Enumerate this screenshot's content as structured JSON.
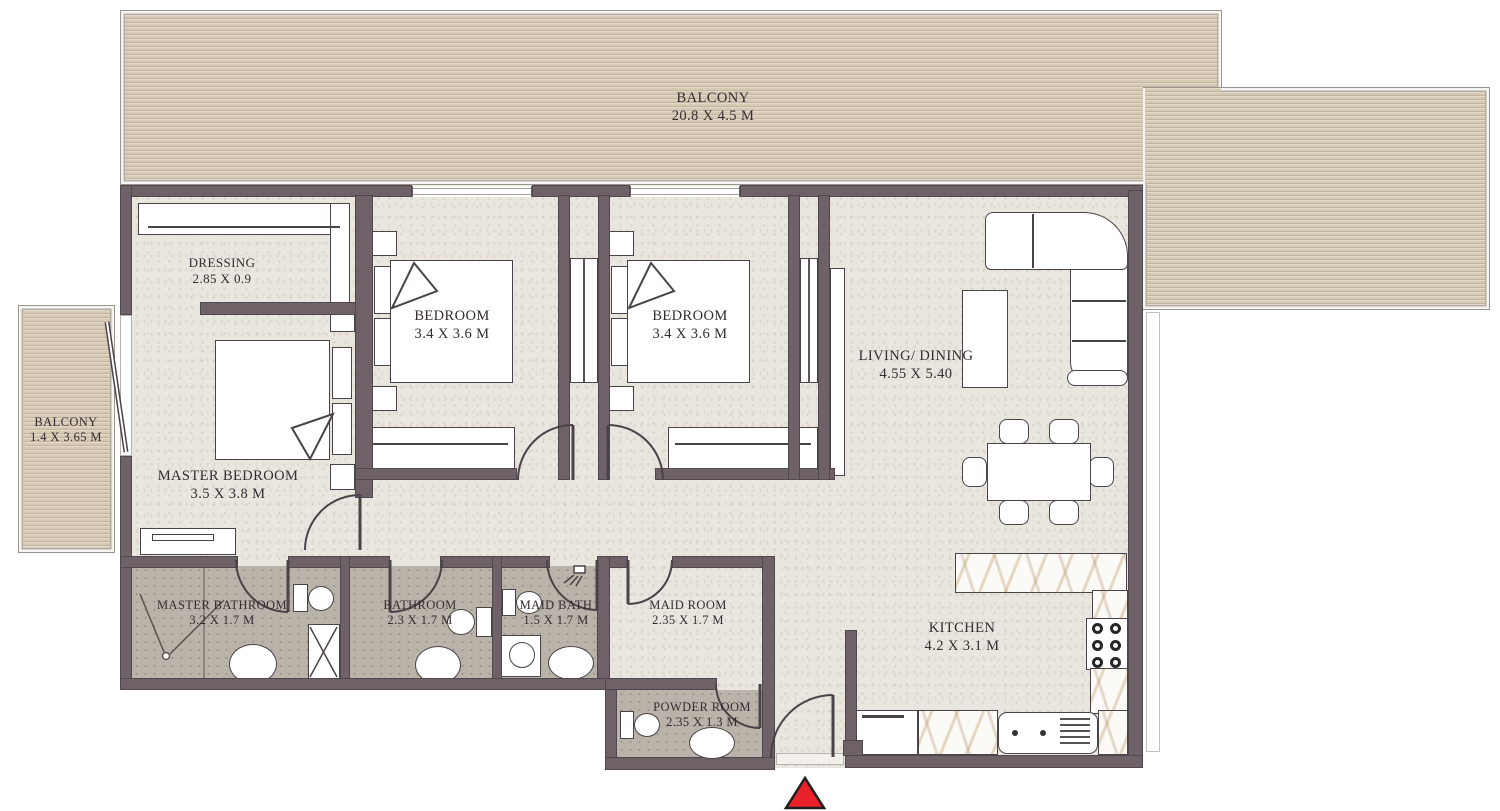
{
  "plan": {
    "rooms": {
      "balcony_top": {
        "name": "BALCONY",
        "dims": "20.8 X 4.5 M"
      },
      "balcony_left": {
        "name": "BALCONY",
        "dims": "1.4 X 3.65 M"
      },
      "dressing": {
        "name": "DRESSING",
        "dims": "2.85 X 0.9"
      },
      "master_bedroom": {
        "name": "MASTER BEDROOM",
        "dims": "3.5 X 3.8 M"
      },
      "bedroom_1": {
        "name": "BEDROOM",
        "dims": "3.4 X 3.6 M"
      },
      "bedroom_2": {
        "name": "BEDROOM",
        "dims": "3.4 X 3.6 M"
      },
      "living_dining": {
        "name": "LIVING/ DINING",
        "dims": "4.55 X 5.40"
      },
      "master_bathroom": {
        "name": "MASTER BATHROOM",
        "dims": "3.2 X 1.7 M"
      },
      "bathroom": {
        "name": "BATHROOM",
        "dims": "2.3 X 1.7 M"
      },
      "maid_bath": {
        "name": "MAID BATH",
        "dims": "1.5 X 1.7 M"
      },
      "maid_room": {
        "name": "MAID ROOM",
        "dims": "2.35 X 1.7 M"
      },
      "powder_room": {
        "name": "POWDER ROOM",
        "dims": "2.35 X 1.3 M"
      },
      "kitchen": {
        "name": "KITCHEN",
        "dims": "4.2 X 3.1 M"
      }
    },
    "entrance": {
      "marker": "entrance-arrow"
    },
    "palette": {
      "wall": "#6e6168",
      "floor": "#e9e6e0",
      "bathroom_floor": "#b9b3aa",
      "balcony_wood": "#d7cab5",
      "marble_vein": "#c19b6a",
      "arrow_red": "#e8212b",
      "text": "#332c30"
    }
  }
}
